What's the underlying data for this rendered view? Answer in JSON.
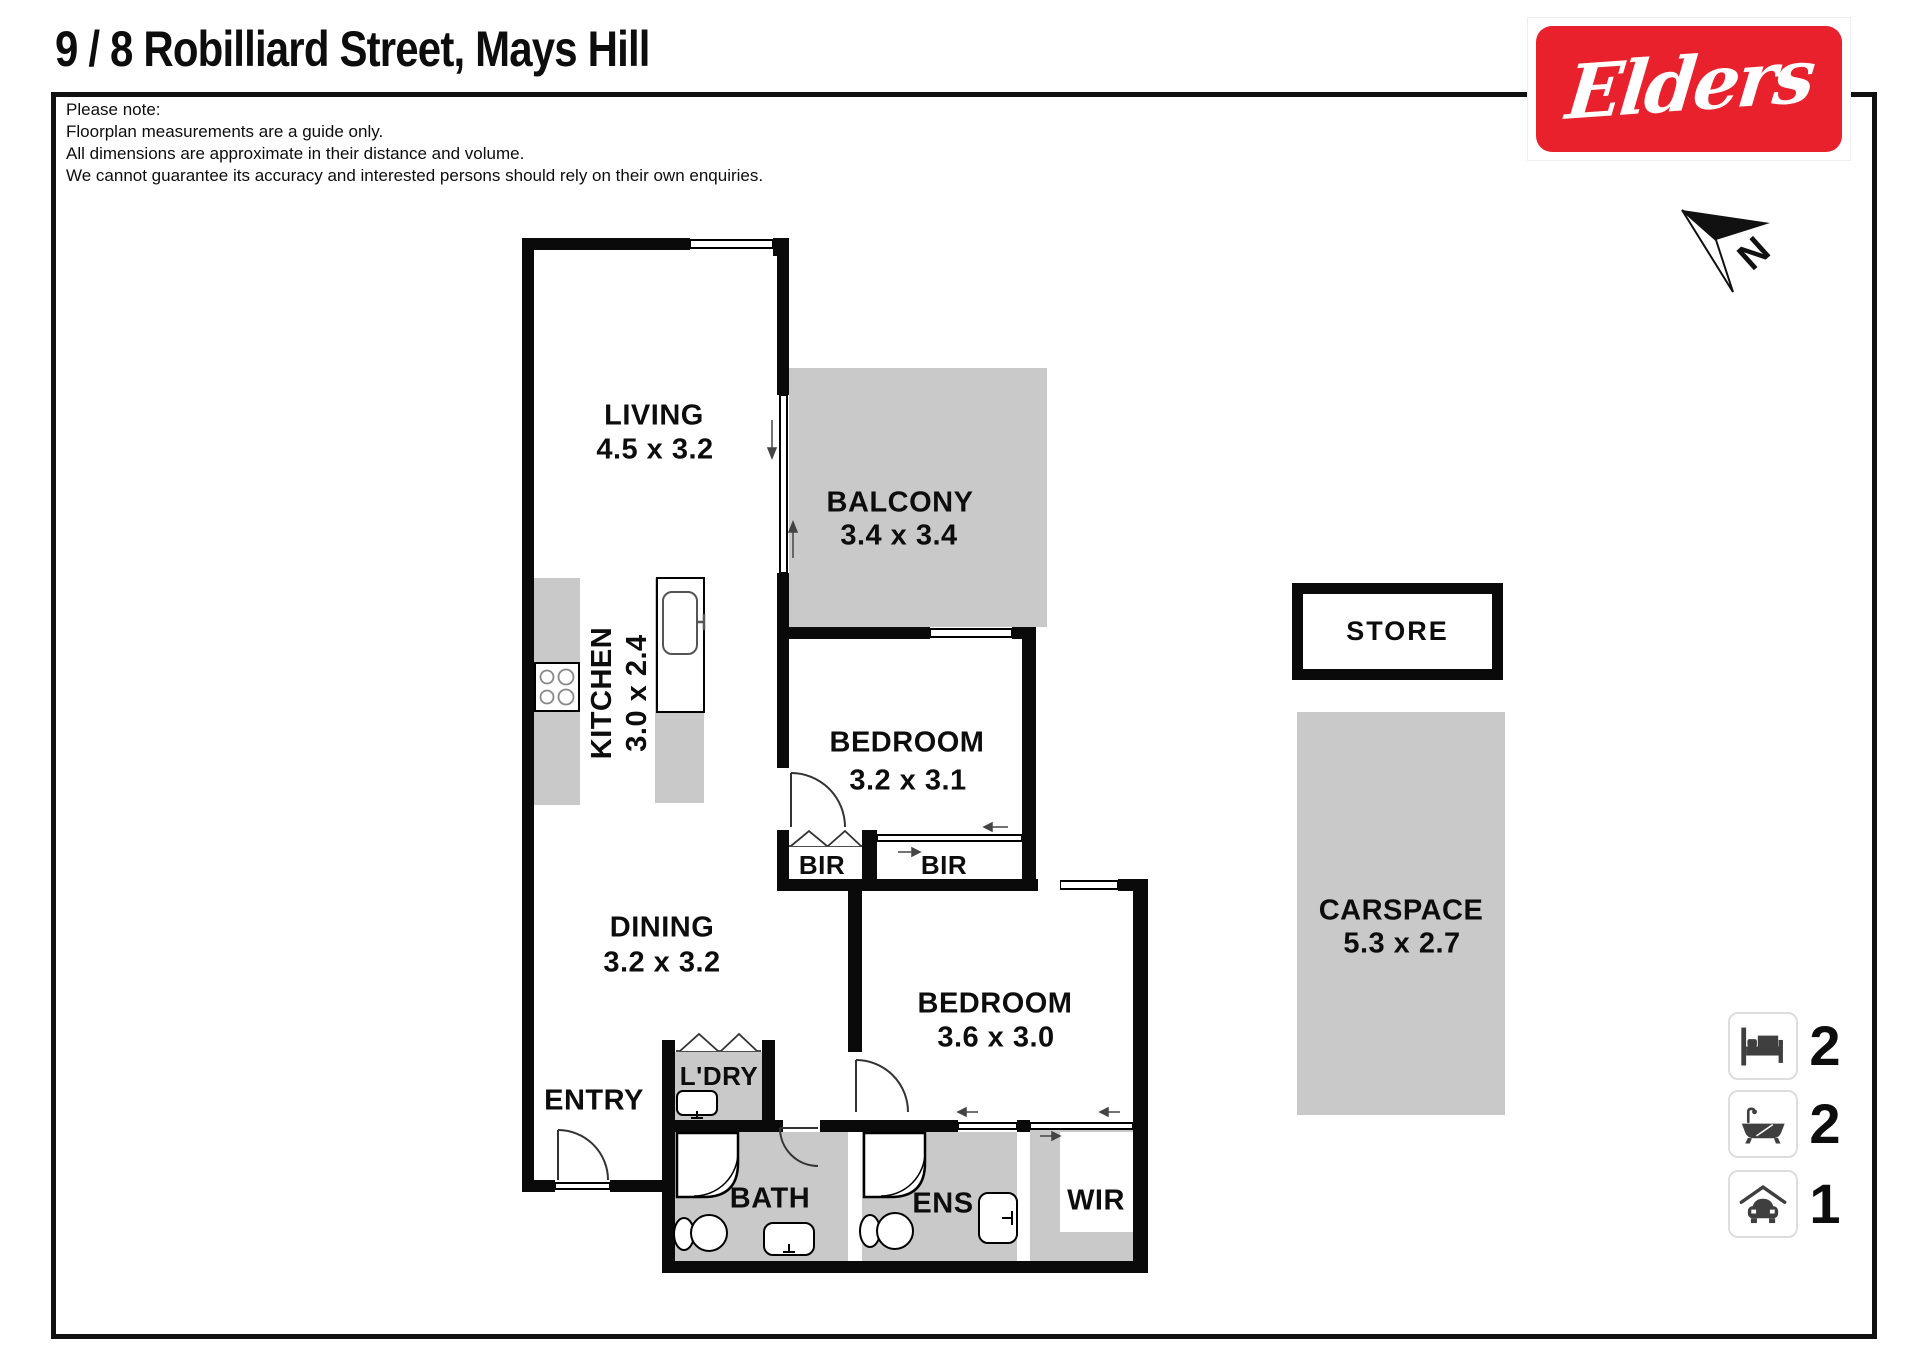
{
  "page": {
    "title": "9 / 8 Robilliard Street, Mays Hill",
    "note_lines": [
      "Please note:",
      "Floorplan measurements are a guide only.",
      "All dimensions are approximate in their distance and volume.",
      "We cannot guarantee its accuracy and interested persons should rely on their own enquiries."
    ],
    "compass_label": "N"
  },
  "brand": {
    "logo_text": "Elders",
    "logo_bg": "#e8212d"
  },
  "rooms": {
    "living": {
      "name": "LIVING",
      "dims": "4.5 x 3.2"
    },
    "balcony": {
      "name": "BALCONY",
      "dims": "3.4 x 3.4"
    },
    "kitchen": {
      "name": "KITCHEN",
      "dims": "3.0 x 2.4"
    },
    "bedroom1": {
      "name": "BEDROOM",
      "dims": "3.2 x 3.1"
    },
    "dining": {
      "name": "DINING",
      "dims": "3.2 x 3.2"
    },
    "bedroom2": {
      "name": "BEDROOM",
      "dims": "3.6 x 3.0"
    },
    "entry": {
      "name": "ENTRY"
    },
    "laundry": {
      "name": "L'DRY"
    },
    "bath": {
      "name": "BATH"
    },
    "ensuite": {
      "name": "ENS"
    },
    "wir": {
      "name": "WIR"
    },
    "bir1": {
      "name": "BIR"
    },
    "bir2": {
      "name": "BIR"
    },
    "store": {
      "name": "STORE"
    },
    "carspace": {
      "name": "CARSPACE",
      "dims": "5.3 x 2.7"
    }
  },
  "legend": {
    "bedrooms": {
      "icon": "bed-icon",
      "count": "2"
    },
    "bathrooms": {
      "icon": "bath-icon",
      "count": "2"
    },
    "carspaces": {
      "icon": "car-icon",
      "count": "1"
    }
  },
  "colors": {
    "area_fill": "#c9c9c9",
    "wall": "#0a0a0a",
    "brand_red": "#e8212d"
  }
}
